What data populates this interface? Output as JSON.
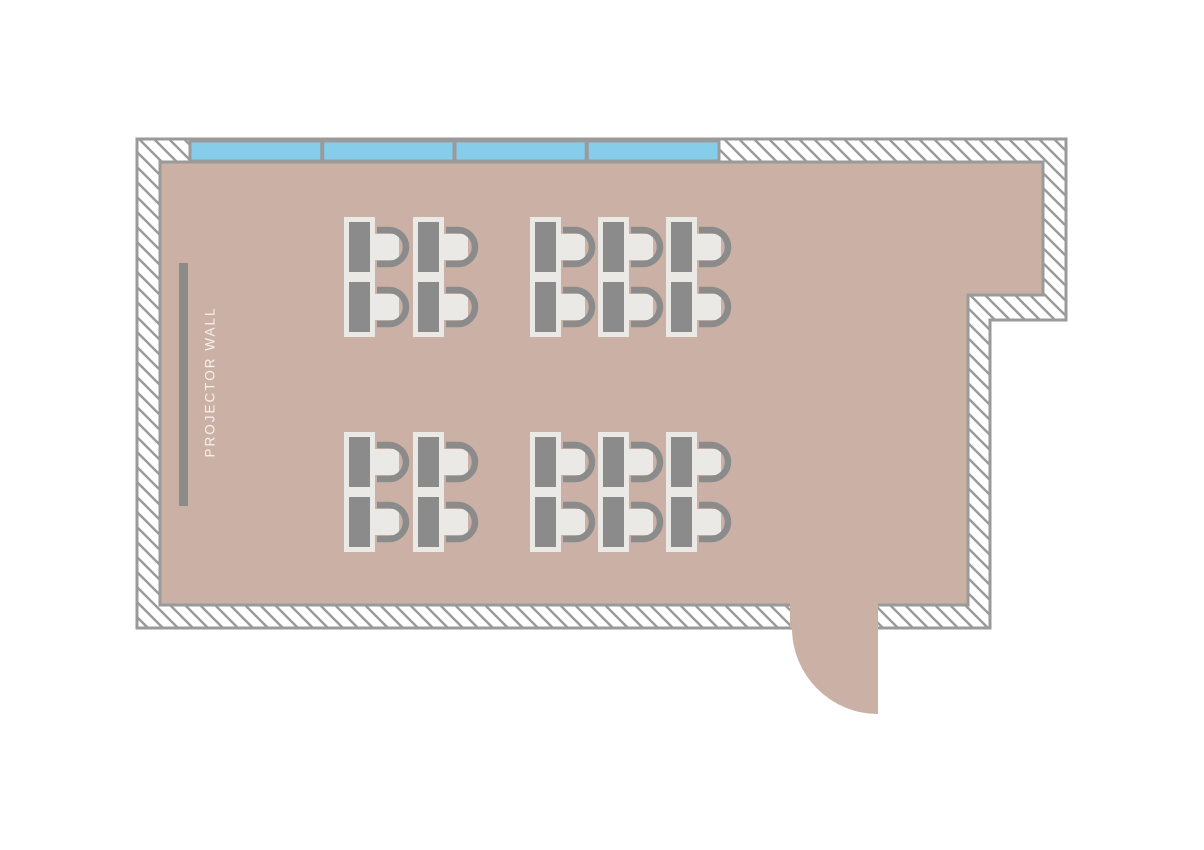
{
  "room": {
    "projector_wall_label": "PROJECTOR WALL",
    "desk_count": 20,
    "chair_count": 20,
    "window_pane_count": 4,
    "door_count": 1
  },
  "colors": {
    "background": "#ffffff",
    "wall_fill": "#ffffff",
    "wall_line": "#9a9a9a",
    "floor": "#cbb1a5",
    "window_glass": "#85cde9",
    "furniture_dark": "#8b8b8b",
    "furniture_light": "#ebe9e6",
    "label_text": "#f6f1ec"
  },
  "floorplan": {
    "outer_wall_points": "137,139 1066,139 1066,320 990,320 990,628 137,628",
    "floor_points": "160,162 1043,162 1043,295 968,295 968,605 160,605",
    "windows": {
      "y": 141,
      "height": 20,
      "x_start": 190,
      "x_end": 719,
      "panes": 4
    },
    "door": {
      "path": "M 790 602 L 878 602 L 878 714 A 86 86 0 0 1 792 628 L 790 628 Z"
    },
    "projector_screen": {
      "x": 179,
      "y": 263,
      "width": 9,
      "height": 243
    },
    "label_transform": "translate(211 382) rotate(-90)",
    "desk": {
      "frame_w": 31,
      "frame_h": 60,
      "inset": 5,
      "seat": {
        "dx": 31,
        "dy": 17,
        "w": 24,
        "h": 26
      },
      "back": {
        "stub_x": 33,
        "cx": 45,
        "r": 17,
        "y1": 13,
        "y2": 47
      }
    },
    "clusters": [
      {
        "name": "top-left",
        "cols": [
          344,
          413
        ],
        "rows": [
          217,
          277
        ]
      },
      {
        "name": "top-right",
        "cols": [
          530,
          598,
          666
        ],
        "rows": [
          217,
          277
        ]
      },
      {
        "name": "bottom-left",
        "cols": [
          344,
          413
        ],
        "rows": [
          432,
          492
        ]
      },
      {
        "name": "bottom-right",
        "cols": [
          530,
          598,
          666
        ],
        "rows": [
          432,
          492
        ]
      }
    ]
  }
}
